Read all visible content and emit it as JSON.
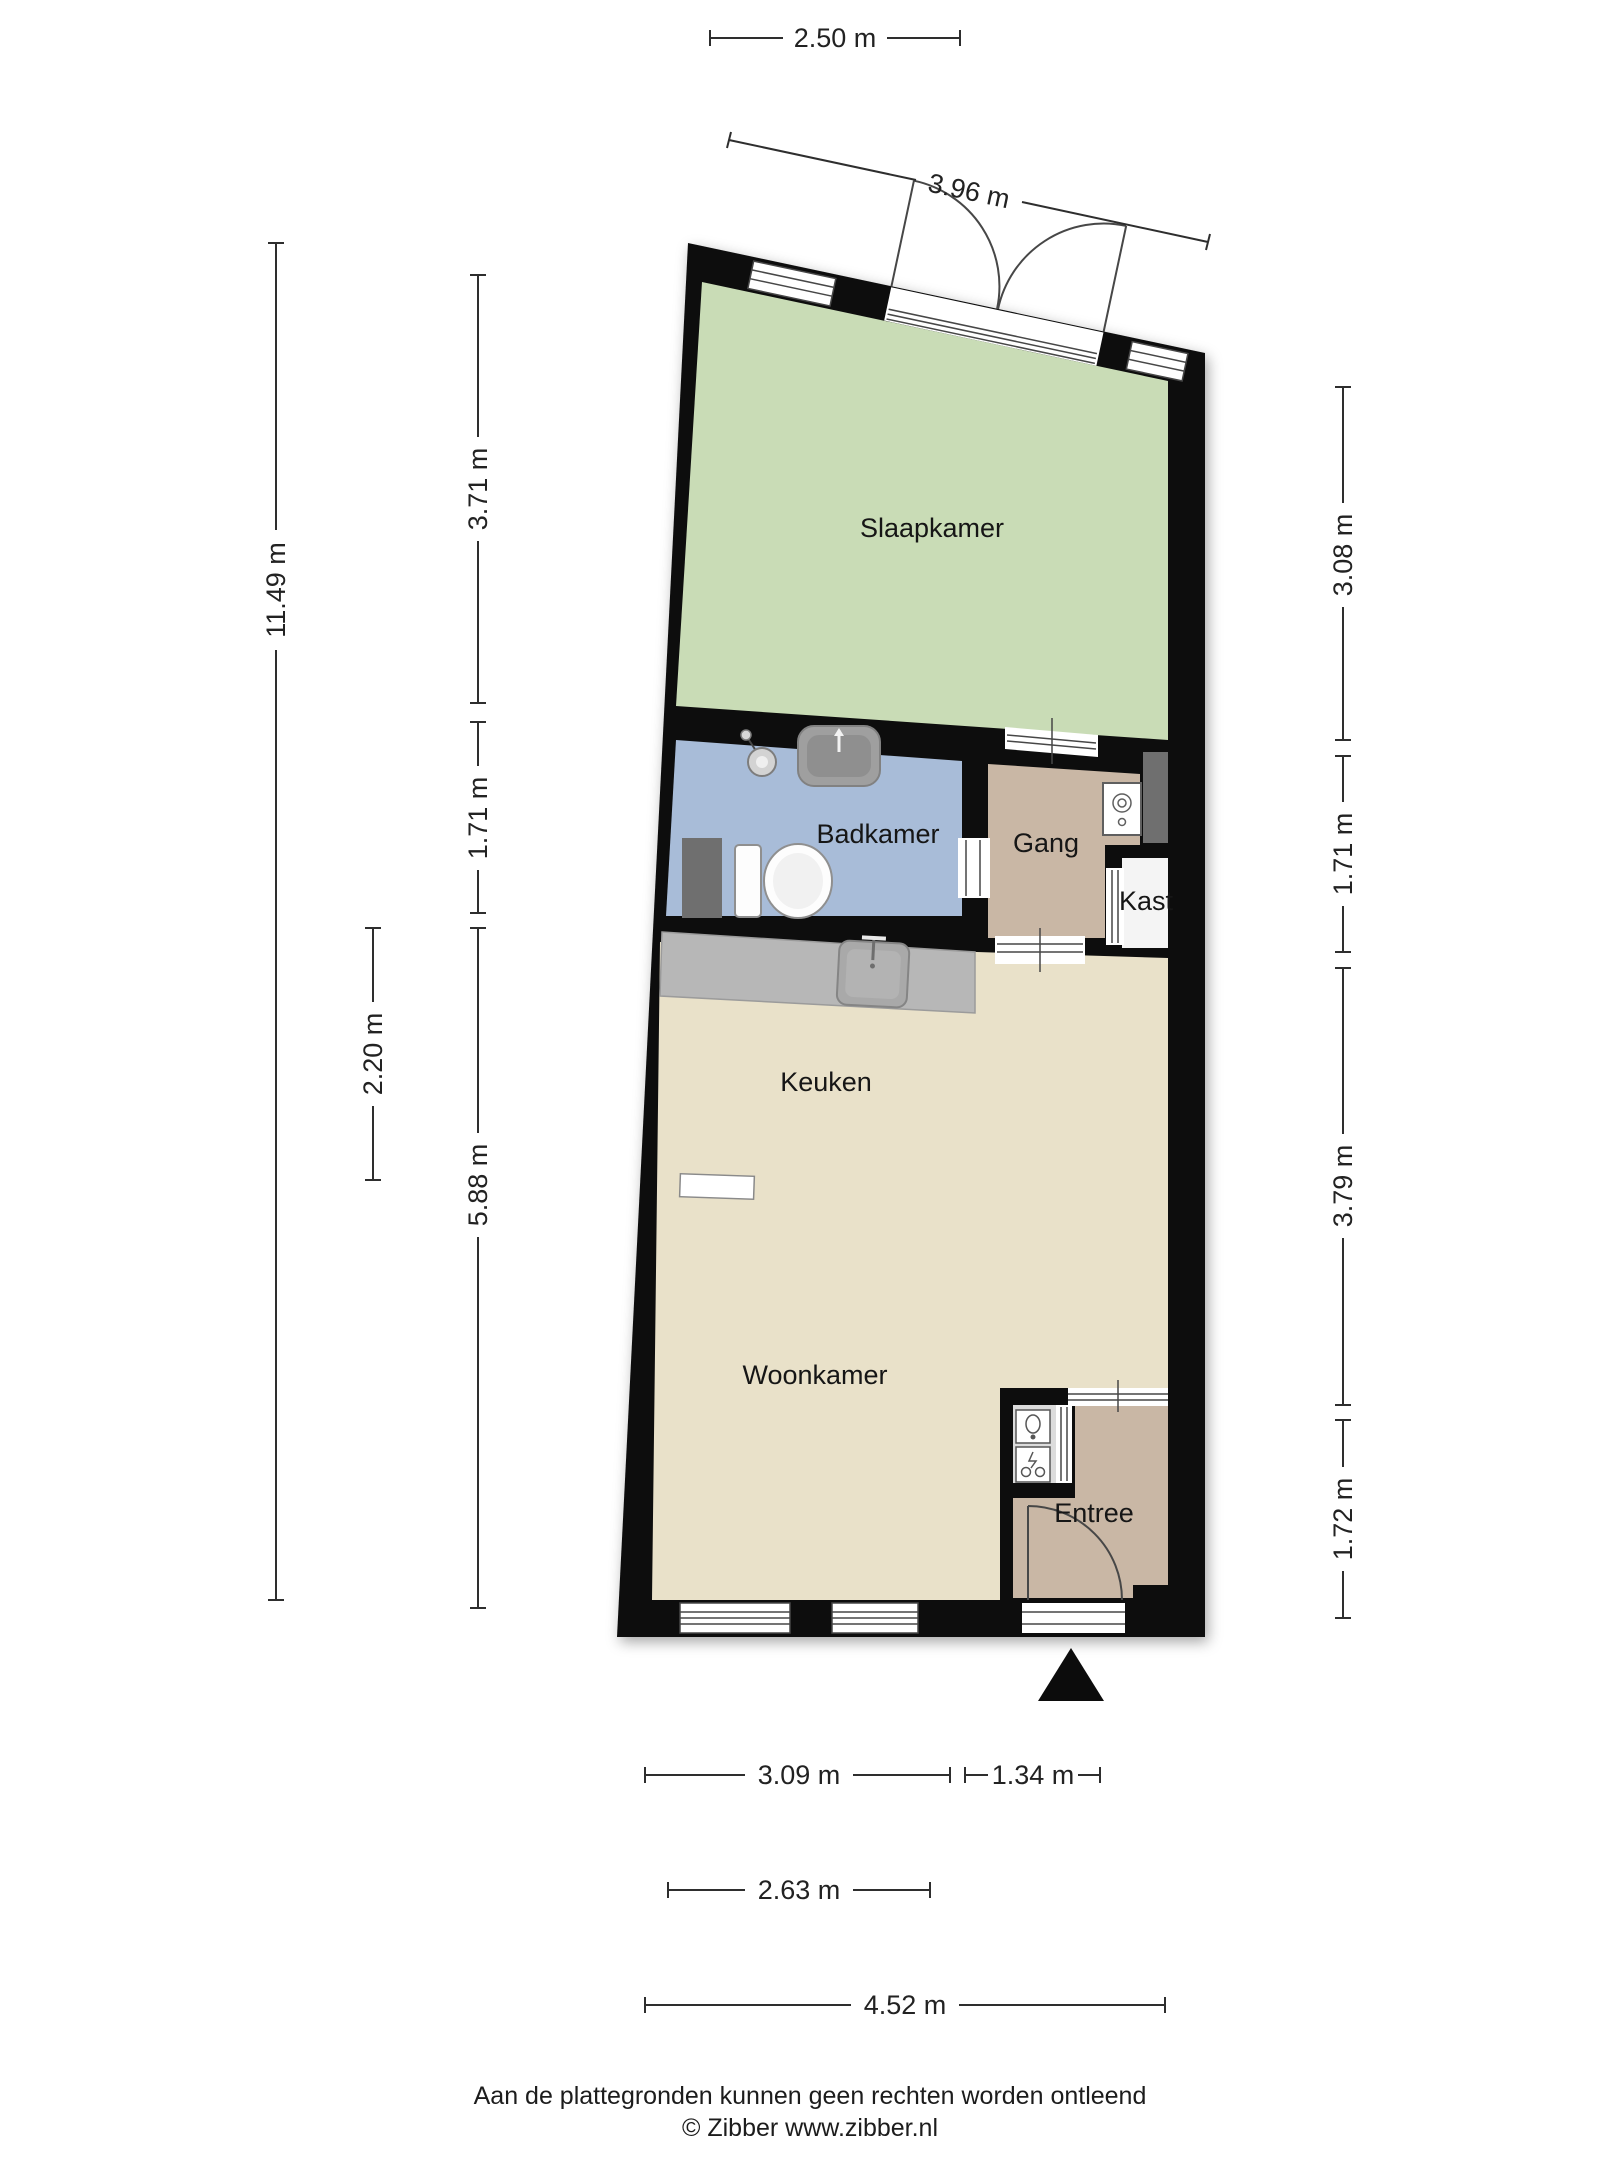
{
  "rooms": {
    "slaapkamer": "Slaapkamer",
    "badkamer": "Badkamer",
    "gang": "Gang",
    "kast": "Kast",
    "keuken": "Keuken",
    "woonkamer": "Woonkamer",
    "entree": "Entree"
  },
  "dimensions": {
    "top_width": "2.50 m",
    "top_wall": "3.96 m",
    "left_total": "11.49 m",
    "left_slaapkamer": "3.71 m",
    "left_badkamer": "1.71 m",
    "left_keuken": "2.20 m",
    "left_woonkamer": "5.88 m",
    "right_slaapkamer": "3.08 m",
    "right_gang": "1.71 m",
    "right_woonkamer": "3.79 m",
    "right_entree": "1.72 m",
    "bottom_woonkamer": "3.09 m",
    "bottom_entree": "1.34 m",
    "bottom_inner": "2.63 m",
    "bottom_total": "4.52 m"
  },
  "footer": {
    "disclaimer": "Aan de plattegronden kunnen geen rechten worden ontleend",
    "copyright": "© Zibber www.zibber.nl"
  },
  "colors": {
    "wall": "#0c0c0c",
    "slaapkamer": "#c9dcb6",
    "badkamer": "#a8bcd8",
    "gang": "#c9b7a5",
    "living": "#e9e1c9",
    "counter": "#b7b7b7",
    "kast": "#f4f4f4",
    "vestibule": "#dcdcdc",
    "shaft": "#6f6f6f"
  }
}
